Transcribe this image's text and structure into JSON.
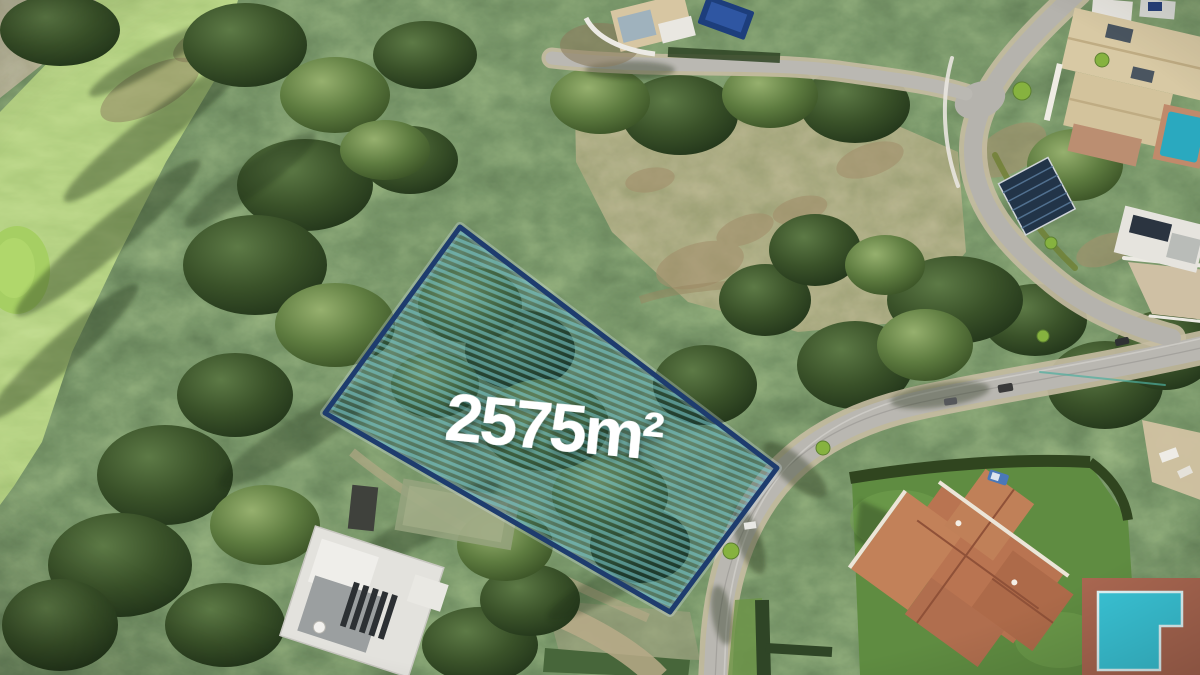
{
  "overlay": {
    "area_label": "2575m²",
    "border_color": "#1e3c6e",
    "stripe_color": "#7ed0d4",
    "tint_color": "#0e3a52",
    "label_color": "#ffffff"
  },
  "scene": {
    "palette": {
      "forest_green": "#3f5a2f",
      "fairway_green": "#7fb14c",
      "putting_green": "#a6cf63",
      "road_asphalt": "#b9b7b1",
      "road_shoulder": "#c7bda2",
      "dirt": "#8f8063",
      "villa_roof_terracotta": "#b97451",
      "villa_roof_cream": "#d8c9a4",
      "pool_turquoise": "#39c2d4",
      "pool_navy": "#1d3e7c",
      "lawn": "#5f8c41"
    }
  }
}
